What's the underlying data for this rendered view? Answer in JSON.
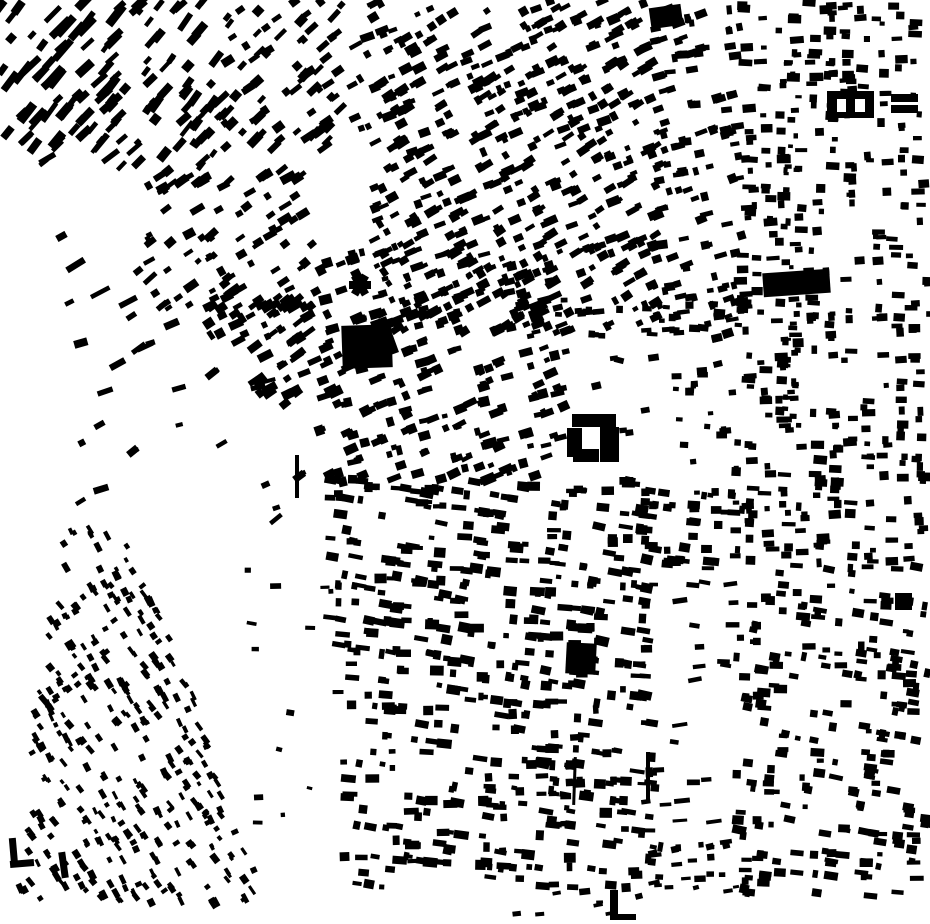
{
  "map": {
    "kind": "figure-ground-building-footprint-map",
    "canvas": {
      "width": 930,
      "height": 924,
      "background_color": "#ffffff",
      "building_color": "#000000"
    },
    "seed": 7,
    "clusters": [
      {
        "name": "top-left-a",
        "x": 0,
        "y": 0,
        "w": 120,
        "h": 148,
        "angle": -48,
        "row": 15,
        "count": 70,
        "bw": [
          8,
          26
        ],
        "bh": [
          4,
          9
        ],
        "jitter": 14
      },
      {
        "name": "top-left-b",
        "x": 112,
        "y": 0,
        "w": 118,
        "h": 168,
        "angle": -48,
        "row": 15,
        "count": 72,
        "bw": [
          6,
          20
        ],
        "bh": [
          4,
          9
        ],
        "jitter": 16
      },
      {
        "name": "top-left-c",
        "x": 225,
        "y": 0,
        "w": 118,
        "h": 152,
        "angle": -40,
        "row": 16,
        "count": 70,
        "bw": [
          6,
          16
        ],
        "bh": [
          4,
          9
        ],
        "jitter": 18
      },
      {
        "name": "top-center",
        "x": 352,
        "y": 0,
        "w": 308,
        "h": 142,
        "angle": -27,
        "row": 15,
        "count": 225,
        "bw": [
          5,
          14
        ],
        "bh": [
          4,
          9
        ],
        "jitter": 16
      },
      {
        "name": "top-center-low",
        "x": 372,
        "y": 138,
        "w": 290,
        "h": 196,
        "angle": -27,
        "row": 15,
        "count": 285,
        "bw": [
          5,
          14
        ],
        "bh": [
          4,
          9
        ],
        "jitter": 16
      },
      {
        "name": "center-mid",
        "x": 318,
        "y": 252,
        "w": 248,
        "h": 232,
        "angle": -20,
        "row": 15,
        "count": 235,
        "bw": [
          5,
          14
        ],
        "bh": [
          4,
          10
        ],
        "jitter": 16
      },
      {
        "name": "center-low",
        "x": 330,
        "y": 478,
        "w": 318,
        "h": 218,
        "angle": 6,
        "row": 15,
        "count": 300,
        "bw": [
          5,
          15
        ],
        "bh": [
          4,
          10
        ],
        "jitter": 14
      },
      {
        "name": "center-bottom",
        "x": 342,
        "y": 692,
        "w": 320,
        "h": 196,
        "angle": 4,
        "row": 15,
        "count": 225,
        "bw": [
          5,
          15
        ],
        "bh": [
          4,
          10
        ],
        "jitter": 16
      },
      {
        "name": "east-of-plaza-top",
        "x": 655,
        "y": 0,
        "w": 85,
        "h": 135,
        "angle": -12,
        "row": 16,
        "count": 48,
        "bw": [
          5,
          13
        ],
        "bh": [
          4,
          9
        ],
        "jitter": 18
      },
      {
        "name": "east-of-plaza",
        "x": 652,
        "y": 130,
        "w": 90,
        "h": 205,
        "angle": -15,
        "row": 15,
        "count": 72,
        "bw": [
          5,
          13
        ],
        "bh": [
          4,
          9
        ],
        "jitter": 16
      },
      {
        "name": "plaza-north-row",
        "x": 558,
        "y": 300,
        "w": 185,
        "h": 38,
        "angle": -4,
        "balign": 0,
        "row": 13,
        "count": 32,
        "bw": [
          5,
          12
        ],
        "bh": [
          4,
          8
        ],
        "jitter": 14
      },
      {
        "name": "plaza-scatter",
        "x": 558,
        "y": 336,
        "w": 188,
        "h": 148,
        "angle": 0,
        "row": 24,
        "count": 12,
        "bw": [
          5,
          11
        ],
        "bh": [
          4,
          8
        ],
        "jitter": 30
      },
      {
        "name": "plaza-east-cluster",
        "x": 675,
        "y": 368,
        "w": 65,
        "h": 78,
        "angle": 85,
        "balign": 0,
        "row": 14,
        "count": 17,
        "bw": [
          5,
          12
        ],
        "bh": [
          4,
          9
        ],
        "jitter": 12
      },
      {
        "name": "south-of-plaza",
        "x": 645,
        "y": 478,
        "w": 100,
        "h": 86,
        "angle": 4,
        "row": 14,
        "count": 42,
        "bw": [
          5,
          13
        ],
        "bh": [
          4,
          9
        ],
        "jitter": 12
      },
      {
        "name": "gap-strip-scatter",
        "x": 635,
        "y": 558,
        "w": 100,
        "h": 292,
        "angle": 0,
        "row": 20,
        "count": 28,
        "bw": [
          7,
          16
        ],
        "bh": [
          3,
          6
        ],
        "jitter": 22
      },
      {
        "name": "gap-strip-bottom",
        "x": 652,
        "y": 832,
        "w": 90,
        "h": 60,
        "angle": -8,
        "row": 15,
        "count": 20,
        "bw": [
          5,
          12
        ],
        "bh": [
          3,
          7
        ],
        "jitter": 16
      },
      {
        "name": "right-top",
        "x": 735,
        "y": 0,
        "w": 195,
        "h": 232,
        "angle": 88,
        "balign": 0,
        "row": 17,
        "count": 150,
        "bw": [
          5,
          14
        ],
        "bh": [
          4,
          9
        ],
        "jitter": 10
      },
      {
        "name": "right-mid",
        "x": 735,
        "y": 232,
        "w": 195,
        "h": 332,
        "angle": 88,
        "balign": 0,
        "row": 17,
        "count": 225,
        "bw": [
          5,
          14
        ],
        "bh": [
          4,
          9
        ],
        "jitter": 10
      },
      {
        "name": "right-bottom",
        "x": 735,
        "y": 564,
        "w": 195,
        "h": 332,
        "angle": 84,
        "balign": 6,
        "row": 17,
        "count": 225,
        "bw": [
          5,
          14
        ],
        "bh": [
          4,
          9
        ],
        "jitter": 14
      },
      {
        "name": "right-street-line",
        "x": 784,
        "y": 55,
        "w": 15,
        "h": 385,
        "angle": 90,
        "balign": 0,
        "row": 42,
        "count": 42,
        "bw": [
          4,
          9
        ],
        "bh": [
          3,
          6
        ],
        "jitter": 8
      },
      {
        "name": "left-mid-a",
        "x": 148,
        "y": 168,
        "w": 165,
        "h": 146,
        "angle": -35,
        "row": 16,
        "count": 92,
        "bw": [
          5,
          16
        ],
        "bh": [
          4,
          9
        ],
        "jitter": 16
      },
      {
        "name": "left-mid-b",
        "x": 208,
        "y": 288,
        "w": 108,
        "h": 108,
        "angle": -32,
        "row": 15,
        "count": 58,
        "bw": [
          5,
          16
        ],
        "bh": [
          4,
          10
        ],
        "jitter": 16
      },
      {
        "name": "sparse-left-band",
        "x": 15,
        "y": 150,
        "w": 148,
        "h": 288,
        "angle": -32,
        "row": 34,
        "count": 13,
        "bw": [
          9,
          22
        ],
        "bh": [
          4,
          7
        ],
        "jitter": 14
      },
      {
        "name": "sparse-mid-left",
        "x": 75,
        "y": 320,
        "w": 238,
        "h": 200,
        "angle": -25,
        "row": 30,
        "count": 22,
        "bw": [
          6,
          16
        ],
        "bh": [
          4,
          8
        ],
        "jitter": 30
      },
      {
        "name": "sparse-west-band",
        "x": 245,
        "y": 520,
        "w": 95,
        "h": 372,
        "angle": 80,
        "balign": 10,
        "row": 26,
        "count": 14,
        "bw": [
          4,
          11
        ],
        "bh": [
          3,
          6
        ],
        "jitter": 30
      },
      {
        "name": "southwest-triangle",
        "x": 15,
        "y": 510,
        "w": 250,
        "h": 400,
        "angle": 58,
        "row": 13,
        "count": 355,
        "bw": [
          4,
          10
        ],
        "bh": [
          3,
          7
        ],
        "jitter": 18,
        "poly": [
          [
            68,
            512
          ],
          [
            130,
            534
          ],
          [
            264,
            876
          ],
          [
            242,
            908
          ],
          [
            16,
            898
          ],
          [
            38,
            690
          ]
        ]
      },
      {
        "name": "bottom-strip",
        "x": 500,
        "y": 884,
        "w": 200,
        "h": 36,
        "angle": -10,
        "row": 16,
        "count": 10,
        "bw": [
          5,
          12
        ],
        "bh": [
          3,
          7
        ],
        "jitter": 16
      }
    ],
    "landmarks": [
      {
        "name": "large-block-main",
        "x": 342,
        "y": 325,
        "w": 50,
        "h": 43,
        "rot": -2
      },
      {
        "name": "large-block-annex",
        "x": 376,
        "y": 318,
        "w": 17,
        "h": 38,
        "rot": -20
      },
      {
        "name": "propeller-arm-1",
        "x": 349,
        "y": 281,
        "w": 22,
        "h": 8,
        "rot": 0
      },
      {
        "name": "propeller-arm-2",
        "x": 349,
        "y": 281,
        "w": 22,
        "h": 8,
        "rot": 60
      },
      {
        "name": "propeller-arm-3",
        "x": 349,
        "y": 281,
        "w": 22,
        "h": 8,
        "rot": 120
      },
      {
        "name": "right-column-slab",
        "x": 763,
        "y": 271,
        "w": 67,
        "h": 24,
        "rot": -4
      },
      {
        "name": "courtyard-north-bar",
        "x": 572,
        "y": 414,
        "w": 44,
        "h": 13,
        "rot": 0
      },
      {
        "name": "courtyard-west-bar",
        "x": 567,
        "y": 428,
        "w": 15,
        "h": 29,
        "rot": 0
      },
      {
        "name": "courtyard-east-block",
        "x": 600,
        "y": 427,
        "w": 19,
        "h": 35,
        "rot": 0
      },
      {
        "name": "courtyard-south-bar",
        "x": 573,
        "y": 449,
        "w": 26,
        "h": 13,
        "rot": 0
      },
      {
        "name": "south-plaza-blob",
        "x": 566,
        "y": 643,
        "w": 30,
        "h": 31,
        "rot": 3
      },
      {
        "name": "north-edge-blob",
        "x": 650,
        "y": 6,
        "w": 32,
        "h": 21,
        "rot": -8
      },
      {
        "name": "ne-courtyard-building",
        "x": 827,
        "y": 91,
        "w": 47,
        "h": 27,
        "rot": 0
      },
      {
        "name": "ne-bar-upper",
        "x": 891,
        "y": 94,
        "w": 27,
        "h": 8,
        "rot": 0
      },
      {
        "name": "ne-bar-lower",
        "x": 891,
        "y": 105,
        "w": 27,
        "h": 8,
        "rot": 0
      },
      {
        "name": "thin-wall-west",
        "x": 295,
        "y": 455,
        "w": 4,
        "h": 43,
        "rot": 0
      },
      {
        "name": "thin-wall-central",
        "x": 646,
        "y": 752,
        "w": 4,
        "h": 50,
        "rot": 0
      },
      {
        "name": "thin-wall-central-2",
        "x": 573,
        "y": 757,
        "w": 3,
        "h": 48,
        "rot": 2
      },
      {
        "name": "bottom-l-vertical",
        "x": 610,
        "y": 890,
        "w": 8,
        "h": 30,
        "rot": 0
      },
      {
        "name": "bottom-l-horizontal",
        "x": 610,
        "y": 914,
        "w": 26,
        "h": 6,
        "rot": 0
      },
      {
        "name": "sw-l-vertical",
        "x": 10,
        "y": 838,
        "w": 7,
        "h": 28,
        "rot": -5
      },
      {
        "name": "sw-l-horizontal",
        "x": 10,
        "y": 860,
        "w": 24,
        "h": 7,
        "rot": -5
      },
      {
        "name": "sw-bar",
        "x": 60,
        "y": 852,
        "w": 7,
        "h": 26,
        "rot": -8
      },
      {
        "name": "far-east-square",
        "x": 895,
        "y": 593,
        "w": 17,
        "h": 17,
        "rot": 0
      }
    ],
    "landmark_holes": [
      {
        "name": "ne-courtyard-hole-west",
        "x": 837,
        "y": 99,
        "w": 9,
        "h": 13
      },
      {
        "name": "ne-courtyard-hole-east",
        "x": 855,
        "y": 99,
        "w": 10,
        "h": 13
      }
    ]
  }
}
